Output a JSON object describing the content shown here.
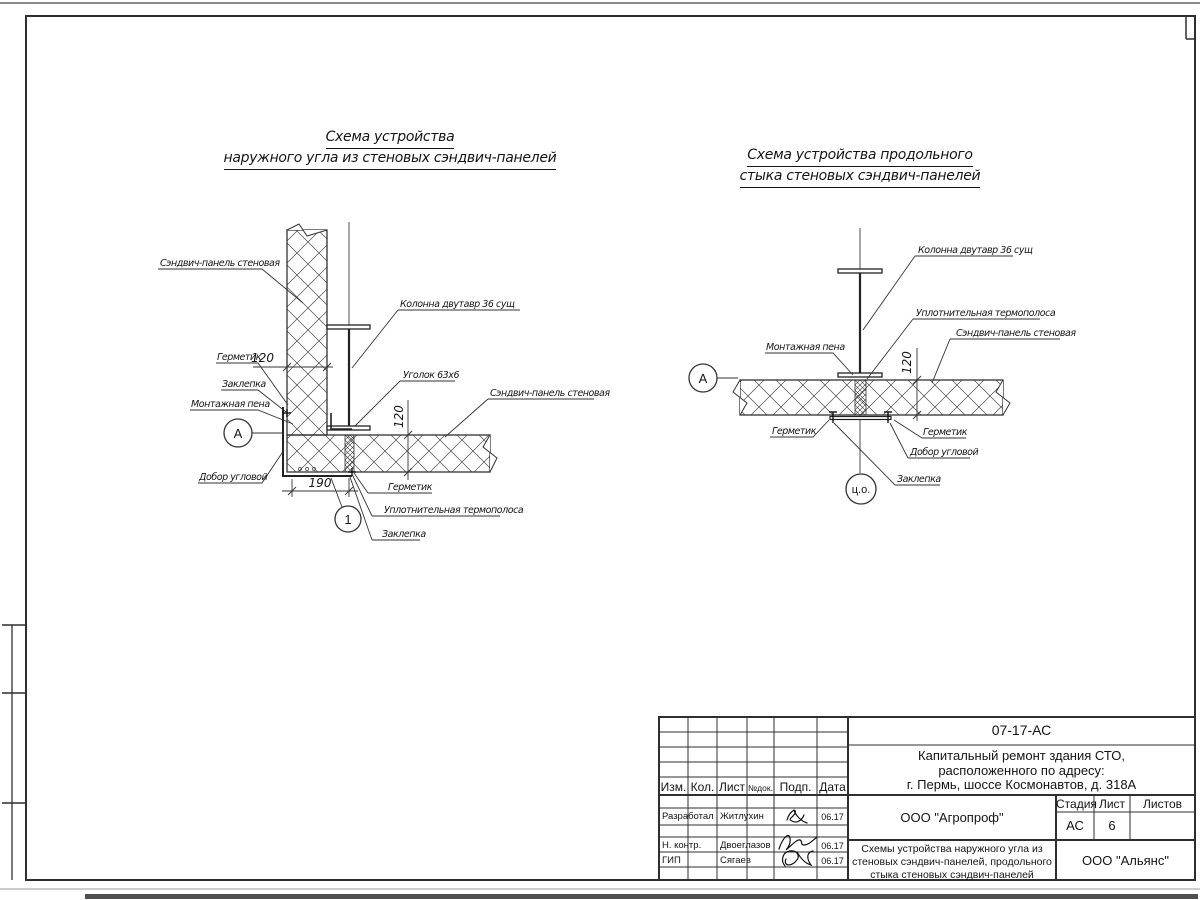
{
  "left_diagram": {
    "title_line1": "Схема устройства",
    "title_line2": "наружного угла из стеновых сэндвич-панелей",
    "labels": {
      "panel": "Сэндвич-панель стеновая",
      "sealant": "Герметик",
      "rivet": "Заклепка",
      "foam": "Монтажная пена",
      "corner_trim": "Добор угловой",
      "column": "Колонна двутавр 36 сущ",
      "angle": "Уголок 63х6",
      "thermo": "Уплотнительная термополоса"
    },
    "dims": {
      "panel_width": "120",
      "panel_thickness": "120",
      "corner_width": "190"
    },
    "markers": {
      "node": "А",
      "detail": "1"
    }
  },
  "right_diagram": {
    "title_line1": "Схема устройства продольного",
    "title_line2": "стыка стеновых сэндвич-панелей",
    "labels": {
      "column": "Колонна двутавр 36 сущ",
      "thermo": "Уплотнительная термополоса",
      "panel": "Сэндвич-панель стеновая",
      "foam": "Монтажная пена",
      "sealant": "Герметик",
      "corner_trim": "Добор угловой",
      "rivet": "Заклепка"
    },
    "dims": {
      "panel_thickness": "120"
    },
    "markers": {
      "node": "А",
      "axis": "ц.о."
    }
  },
  "title_block": {
    "doc_number": "07-17-АС",
    "project_line1": "Капитальный ремонт здания СТО,",
    "project_line2": "расположенного по адресу:",
    "project_line3": "г. Пермь, шоссе Космонавтов, д. 318А",
    "rev_headers": {
      "izm": "Изм.",
      "kol": "Кол.",
      "list": "Лист",
      "ndok": "№док.",
      "podp": "Подп.",
      "data": "Дата"
    },
    "sign_rows": [
      {
        "role": "Разработал",
        "name": "Житлухин",
        "date": "06.17"
      },
      {
        "role": "Н. контр.",
        "name": "Двоеглазов",
        "date": "06.17"
      },
      {
        "role": "ГИП",
        "name": "Сягаев",
        "date": "06.17"
      }
    ],
    "org_top": "ООО \"Агропроф\"",
    "sheet_name_line1": "Схемы устройства наружного угла из",
    "sheet_name_line2": "стеновых сэндвич-панелей, продольного",
    "sheet_name_line3": "стыка стеновых сэндвич-панелей",
    "stage_header": "Стадия",
    "list_header": "Лист",
    "listov_header": "Листов",
    "stage_value": "АС",
    "list_value": "6",
    "listov_value": "",
    "org_bottom": "ООО \"Альянс\""
  }
}
